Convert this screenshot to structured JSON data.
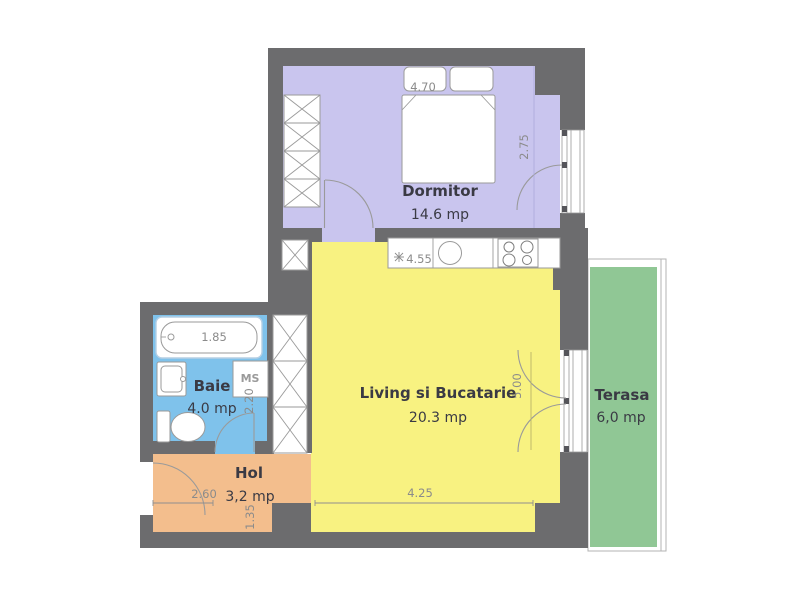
{
  "rooms": [
    {
      "name": "Dormitor",
      "area": "14.6 mp",
      "color": "#c9c5ee"
    },
    {
      "name": "Living si Bucatarie",
      "area": "20.3 mp",
      "color": "#f8f281"
    },
    {
      "name": "Baie",
      "area": "4.0 mp",
      "color": "#7fc2eb"
    },
    {
      "name": "Hol",
      "area": "3,2 mp",
      "color": "#f3be8d"
    },
    {
      "name": "Terasa",
      "area": "6,0 mp",
      "color": "#90c795"
    }
  ],
  "dimensions": {
    "bedroom_width": "4.70",
    "bedroom_depth": "2.75",
    "kitchen_run": "4.55",
    "living_depth": "5.00",
    "living_width": "4.25",
    "bathtub_length": "1.85",
    "bath_depth": "2.20",
    "hall_width": "2.60",
    "hall_depth": "1.35"
  },
  "fixtures": {
    "washing_machine_label": "MS"
  },
  "colors": {
    "wall": "#6c6c6e",
    "outline": "#9a9a9a",
    "dimension_text": "#8b8b8b",
    "room_text": "#3a3a44"
  }
}
